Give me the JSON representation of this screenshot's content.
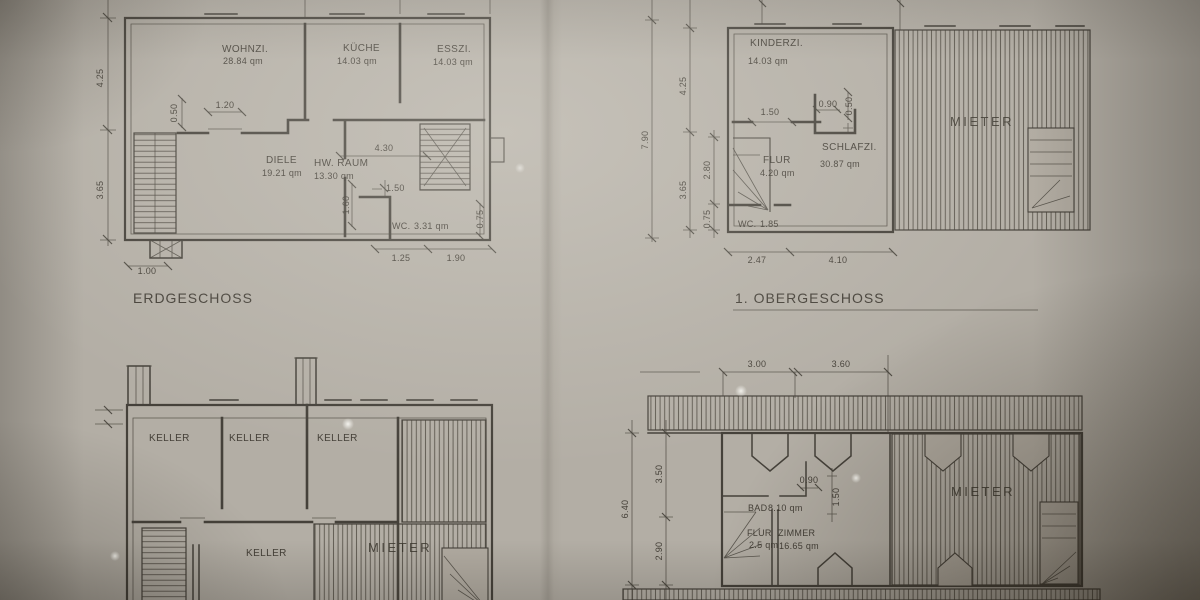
{
  "plans": {
    "erdgeschoss": {
      "title": "ERDGESCHOSS",
      "rooms": {
        "wohnzimmer": {
          "name": "WOHNZI.",
          "area": "28.84 qm"
        },
        "kueche": {
          "name": "KÜCHE",
          "area": "14.03 qm"
        },
        "esszimmer": {
          "name": "ESSZI.",
          "area": "14.03 qm"
        },
        "diele": {
          "name": "DIELE",
          "area": "19.21 qm"
        },
        "hwraum": {
          "name": "HW. RAUM",
          "area": "13.30 qm"
        },
        "wc": {
          "name": "WC.",
          "area": "3.31 qm"
        }
      },
      "dims": {
        "left_upper": "4.25",
        "left_lower": "3.65",
        "window_height": "0.50",
        "window_width": "1.20",
        "hall_width": "4.30",
        "door": "1.50",
        "wc_height": "1.60",
        "right_side": "0.75",
        "bottom_left": "1.25",
        "bottom_right": "1.90",
        "chimney": "1.00"
      }
    },
    "obergeschoss": {
      "title": "1. OBERGESCHOSS",
      "rooms": {
        "kinderzimmer": {
          "name": "KINDERZI.",
          "area": "14.03 qm"
        },
        "flur": {
          "name": "FLUR",
          "area": "4.20 qm"
        },
        "schlafzimmer": {
          "name": "SCHLAFZI.",
          "area": "30.87 qm"
        },
        "wc": {
          "name": "WC.",
          "area": "1.85"
        }
      },
      "mieter": "MIETER",
      "dims": {
        "total_height": "7.90",
        "left_upper": "4.25",
        "left_lower": "3.65",
        "inner_upper": "2.80",
        "inner_lower": "0.75",
        "window_a": "1.50",
        "window_b": "0.90",
        "window_c": "0.50",
        "bottom_left": "2.47",
        "bottom_right": "4.10"
      }
    },
    "keller": {
      "rooms": [
        "KELLER",
        "KELLER",
        "KELLER",
        "KELLER"
      ],
      "mieter": "MIETER"
    },
    "dachgeschoss": {
      "rooms": {
        "bad": {
          "name": "BAD",
          "area": "8.10 qm"
        },
        "flur": {
          "name": "FLUR",
          "area": "2.5 qm"
        },
        "zimmer": {
          "name": "ZIMMER",
          "area": "16.65 qm"
        }
      },
      "mieter": "MIETER",
      "dims": {
        "top_left": "3.00",
        "top_right": "3.60",
        "total_height": "6.40",
        "left_upper": "3.50",
        "left_lower": "2.90",
        "window": "0.90",
        "window_v": "1.50"
      }
    }
  }
}
